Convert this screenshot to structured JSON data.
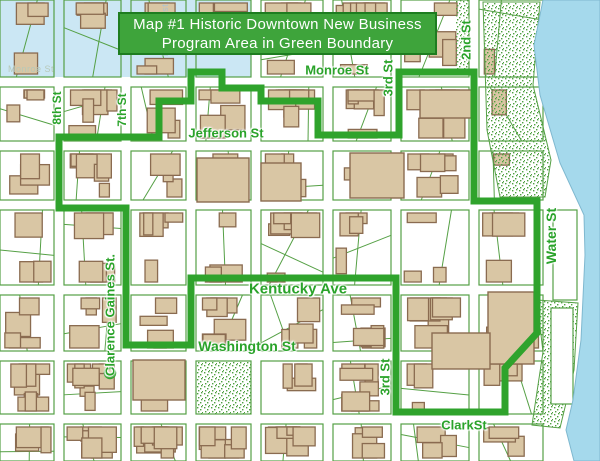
{
  "title": {
    "line1": "Map #1 Historic Downtown New Business",
    "line2": "Program Area in Green Boundary"
  },
  "colors": {
    "banner_fill": "#3ea43b",
    "banner_border": "#1e7d20",
    "banner_text": "#ffffff",
    "label_green": "#2aa32a",
    "boundary_green": "#2fa32c",
    "block_line_green": "#55a045",
    "building_fill": "#d9c6a4",
    "building_stroke": "#8a6b50",
    "water_blue": "#a5d9ec",
    "blue_district": "#cbe7f4",
    "stipple_green": "#4fa040",
    "street_white": "#ffffff",
    "faint_gray_green": "#b7c9b9",
    "faint_gray_blue": "#aec3cf"
  },
  "street_labels": [
    {
      "id": "monroe",
      "text": "Monroe St",
      "x": 337,
      "y": 70,
      "rotate": 0,
      "size": 13
    },
    {
      "id": "jefferson",
      "text": "Jefferson St",
      "x": 226,
      "y": 133,
      "rotate": 0,
      "size": 13
    },
    {
      "id": "kentucky",
      "text": "Kentucky Ave",
      "x": 298,
      "y": 289,
      "rotate": 0,
      "size": 15
    },
    {
      "id": "washington",
      "text": "Washington St",
      "x": 247,
      "y": 346,
      "rotate": 0,
      "size": 14
    },
    {
      "id": "clark",
      "text": "ClarkSt",
      "x": 464,
      "y": 425,
      "rotate": 0,
      "size": 13
    },
    {
      "id": "third-north",
      "text": "3rd St",
      "x": 388,
      "y": 78,
      "rotate": -90,
      "size": 13
    },
    {
      "id": "third-south",
      "text": "3rd St",
      "x": 385,
      "y": 377,
      "rotate": -90,
      "size": 13
    },
    {
      "id": "second",
      "text": "2nd St",
      "x": 466,
      "y": 40,
      "rotate": -90,
      "size": 13
    },
    {
      "id": "water-st",
      "text": "Water St",
      "x": 551,
      "y": 236,
      "rotate": -90,
      "size": 14
    },
    {
      "id": "eighth",
      "text": "8th St",
      "x": 57,
      "y": 108,
      "rotate": -90,
      "size": 12
    },
    {
      "id": "seventh",
      "text": "7th St",
      "x": 122,
      "y": 110,
      "rotate": -90,
      "size": 12
    },
    {
      "id": "clarence-gaines",
      "text": "Clarence Gaines St.",
      "x": 110,
      "y": 315,
      "rotate": -90,
      "size": 13
    }
  ],
  "faint_labels": [
    {
      "id": "north-8th",
      "text": "North 8th st",
      "x": 165,
      "y": 30,
      "rotate": -90,
      "size": 9,
      "color_key": "faint_gray_blue"
    },
    {
      "id": "monroe-west",
      "text": "Monroe St",
      "x": 31,
      "y": 69,
      "rotate": 0,
      "size": 9,
      "color_key": "faint_gray_green"
    }
  ],
  "boundary": {
    "stroke_width": 7,
    "points": [
      [
        191,
        72
      ],
      [
        222,
        72
      ],
      [
        222,
        88
      ],
      [
        261,
        88
      ],
      [
        261,
        101
      ],
      [
        318,
        101
      ],
      [
        318,
        135
      ],
      [
        399,
        135
      ],
      [
        399,
        72
      ],
      [
        474,
        72
      ],
      [
        474,
        201
      ],
      [
        537,
        201
      ],
      [
        537,
        333
      ],
      [
        505,
        368
      ],
      [
        505,
        412
      ],
      [
        396,
        412
      ],
      [
        396,
        278
      ],
      [
        191,
        278
      ],
      [
        191,
        345
      ],
      [
        126,
        345
      ],
      [
        126,
        208
      ],
      [
        59,
        208
      ],
      [
        59,
        137
      ],
      [
        159,
        137
      ],
      [
        159,
        101
      ],
      [
        191,
        101
      ]
    ]
  },
  "water": {
    "points": [
      [
        543,
        0
      ],
      [
        600,
        0
      ],
      [
        600,
        461
      ],
      [
        574,
        461
      ],
      [
        566,
        430
      ],
      [
        573,
        400
      ],
      [
        581,
        340
      ],
      [
        585,
        255
      ],
      [
        584,
        215
      ],
      [
        560,
        163
      ],
      [
        540,
        95
      ],
      [
        534,
        45
      ]
    ]
  }
}
